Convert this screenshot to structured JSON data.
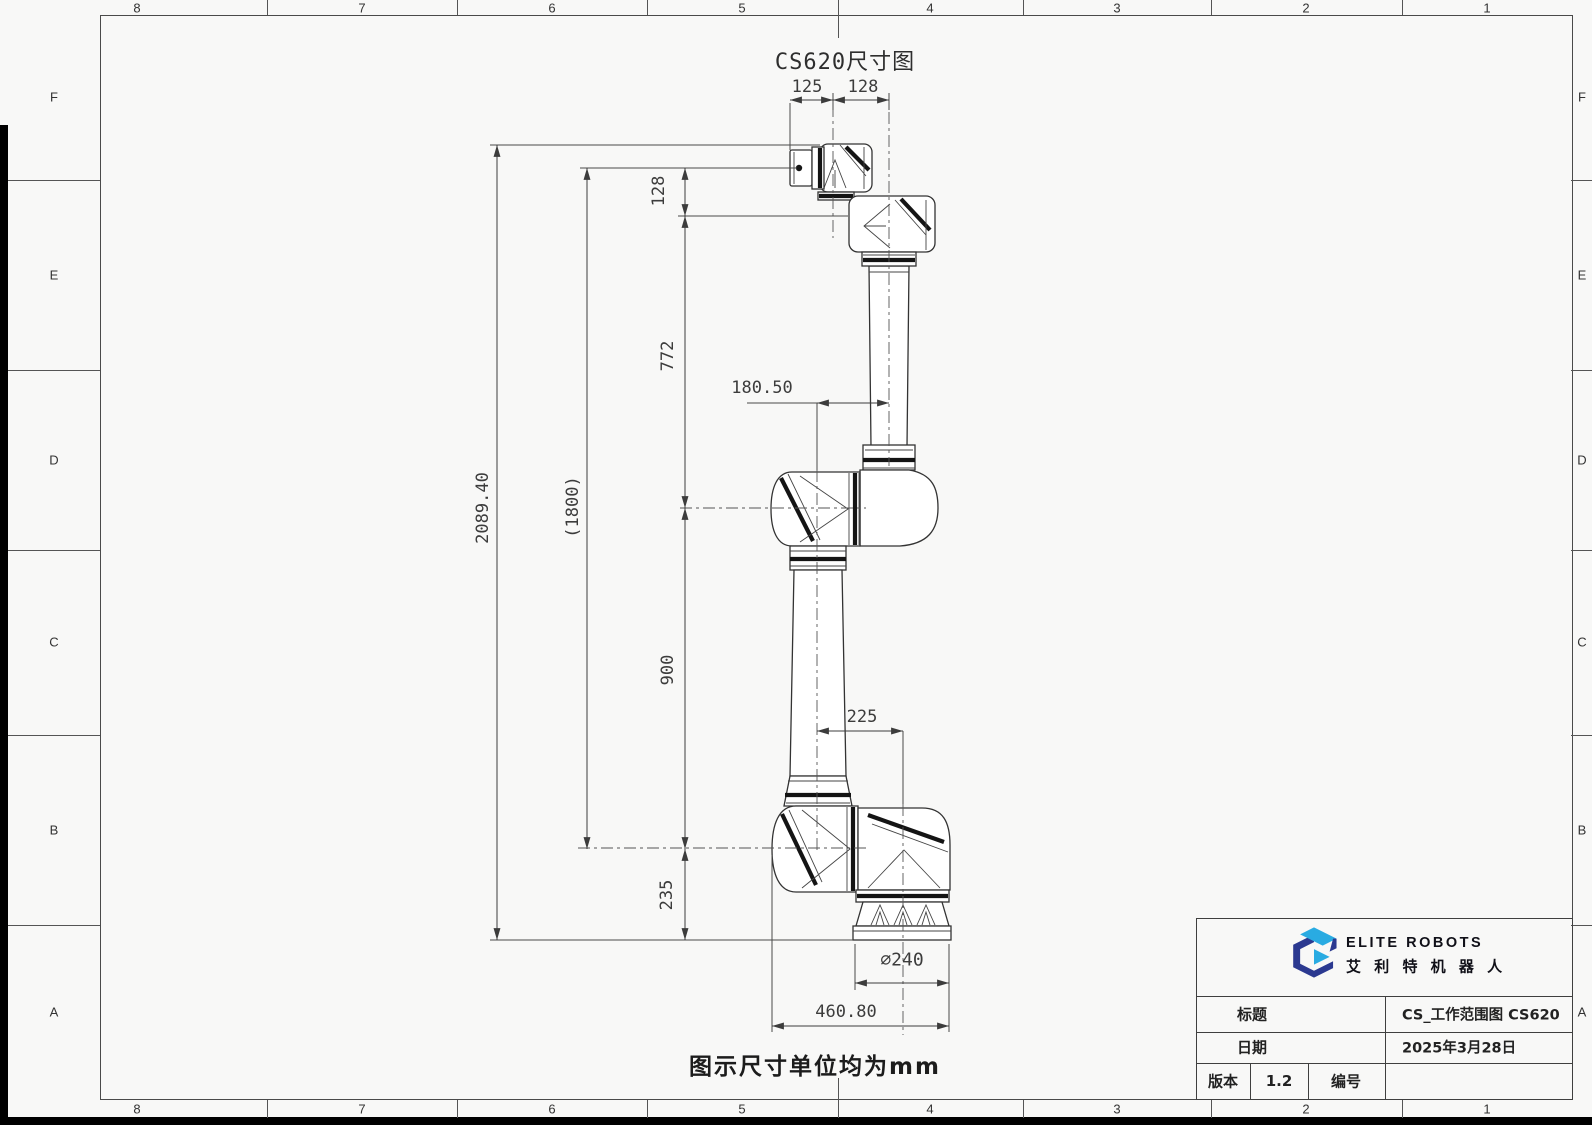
{
  "sheet": {
    "zone_cols": [
      "8",
      "7",
      "6",
      "5",
      "4",
      "3",
      "2",
      "1"
    ],
    "zone_rows": [
      "F",
      "E",
      "D",
      "C",
      "B",
      "A"
    ]
  },
  "drawing": {
    "title": "CS620尺寸图",
    "unit_note": "图示尺寸单位均为mm",
    "dims": {
      "d125": "125",
      "d128_top": "128",
      "d128_side": "128",
      "d772": "772",
      "d1800": "(1800)",
      "d2089_40": "2089.40",
      "d180_50": "180.50",
      "d900": "900",
      "d225": "225",
      "d235": "235",
      "dia240": "∅240",
      "d460_80": "460.80"
    }
  },
  "title_block": {
    "brand": {
      "logo": "elite-cube-logo",
      "name_en": "ELITE ROBOTS",
      "name_cn": "艾 利 特 机 器 人"
    },
    "fields": {
      "title_label": "标题",
      "title_value": "CS_工作范围图 CS620",
      "date_label": "日期",
      "date_value": "2025年3月28日",
      "version_label": "版本",
      "version_value": "1.2",
      "number_label": "编号",
      "number_value": ""
    }
  },
  "colors": {
    "brand_dark": "#2b3990",
    "brand_light": "#29abe2",
    "line": "#3f3f3f",
    "paper": "#f8f8f7"
  }
}
